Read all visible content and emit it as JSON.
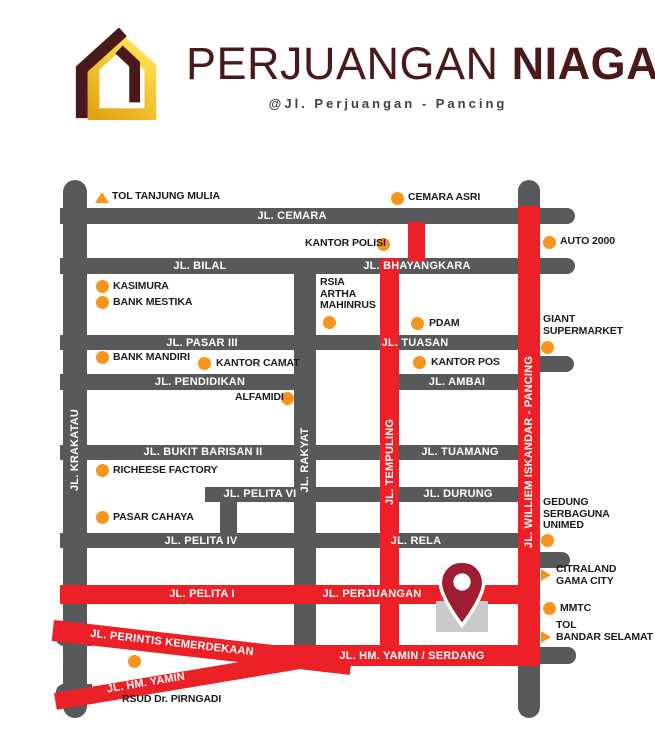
{
  "header": {
    "title_regular": "PERJUANGAN",
    "title_bold": "NIAGA",
    "subtitle": "@Jl. Perjuangan - Pancing"
  },
  "colors": {
    "road_gray": "#58595B",
    "road_red": "#EC2027",
    "poi_orange": "#F7941D",
    "brand_maroon": "#4A1A1A",
    "logo_gold_top": "#FFDE4D",
    "logo_gold_bottom": "#E2A313",
    "pin_red": "#9E1D32",
    "building_gray": "#C9CACB",
    "subtitle_gray": "#414042",
    "poi_text": "#1E1A1B"
  },
  "map": {
    "roads": [
      {
        "id": "jl-krakatau",
        "color": "gray",
        "x": 63,
        "y": 180,
        "w": 24,
        "h": 538,
        "r": "12px"
      },
      {
        "id": "pancing-north-stub",
        "color": "gray",
        "x": 518,
        "y": 180,
        "w": 22,
        "h": 42,
        "r": "11px 11px 0 0"
      },
      {
        "id": "jl-rakyat",
        "color": "gray",
        "x": 294,
        "y": 260,
        "w": 22,
        "h": 390
      },
      {
        "id": "pelita-vi-connector",
        "color": "gray",
        "x": 220,
        "y": 490,
        "w": 17,
        "h": 50
      },
      {
        "id": "jl-cemara",
        "color": "gray",
        "x": 60,
        "y": 208,
        "w": 515,
        "h": 16,
        "r": "0 8px 8px 0"
      },
      {
        "id": "jl-bilal-bhayangkara",
        "color": "gray",
        "x": 60,
        "y": 258,
        "w": 515,
        "h": 16,
        "r": "0 8px 8px 0"
      },
      {
        "id": "jl-pasar-iii-tuasan",
        "color": "gray",
        "x": 60,
        "y": 335,
        "w": 458,
        "h": 15
      },
      {
        "id": "jl-pendidikan",
        "color": "gray",
        "x": 60,
        "y": 374,
        "w": 256,
        "h": 16
      },
      {
        "id": "jl-ambai",
        "color": "gray",
        "x": 398,
        "y": 374,
        "w": 120,
        "h": 16
      },
      {
        "id": "jl-bukit-barisan-tuamang",
        "color": "gray",
        "x": 60,
        "y": 445,
        "w": 458,
        "h": 15
      },
      {
        "id": "jl-pelita-vi-durung",
        "color": "gray",
        "x": 205,
        "y": 487,
        "w": 313,
        "h": 15
      },
      {
        "id": "jl-pelita-iv-rela",
        "color": "gray",
        "x": 60,
        "y": 533,
        "w": 458,
        "h": 15
      },
      {
        "id": "east-stub-giant",
        "color": "gray",
        "x": 528,
        "y": 356,
        "w": 46,
        "h": 16,
        "r": "0 8px 8px 0"
      },
      {
        "id": "east-stub-unimed",
        "color": "gray",
        "x": 528,
        "y": 552,
        "w": 42,
        "h": 16,
        "r": "0 8px 8px 0"
      },
      {
        "id": "east-stub-serdang",
        "color": "gray",
        "x": 528,
        "y": 647,
        "w": 48,
        "h": 17,
        "r": "0 8px 8px 0"
      },
      {
        "id": "west-stub-perintis",
        "color": "gray",
        "x": 56,
        "y": 629,
        "w": 36,
        "h": 17,
        "r": "8px 0 0 8px"
      },
      {
        "id": "west-stub-yamin",
        "color": "gray",
        "x": 56,
        "y": 684,
        "w": 36,
        "h": 17,
        "r": "8px 0 0 8px"
      },
      {
        "id": "pancing-south-stub",
        "color": "gray",
        "x": 518,
        "y": 664,
        "w": 22,
        "h": 54,
        "r": "0 0 11px 11px"
      },
      {
        "id": "jl-tempuling-north",
        "color": "red",
        "x": 408,
        "y": 222,
        "w": 17,
        "h": 40
      },
      {
        "id": "jl-tempuling",
        "color": "red",
        "x": 380,
        "y": 258,
        "w": 19,
        "h": 404
      },
      {
        "id": "jl-williem-iskandar-pancing",
        "color": "red",
        "x": 518,
        "y": 206,
        "w": 22,
        "h": 460
      },
      {
        "id": "jl-pelita-i-perjuangan",
        "color": "red",
        "x": 60,
        "y": 585,
        "w": 480,
        "h": 19
      },
      {
        "id": "jl-perintis-kemerdekaan",
        "color": "red",
        "x": 54,
        "y": 620,
        "w": 300,
        "h": 21,
        "rot": 6.5
      },
      {
        "id": "jl-hm-yamin-diag",
        "color": "red",
        "x": 54,
        "y": 693,
        "w": 245,
        "h": 17,
        "rot": -9.5
      },
      {
        "id": "jl-hm-yamin-serdang",
        "color": "red",
        "x": 255,
        "y": 645,
        "w": 285,
        "h": 21
      }
    ],
    "road_labels": [
      {
        "text": "JL. CEMARA",
        "x": 292,
        "y": 216
      },
      {
        "text": "JL. BILAL",
        "x": 200,
        "y": 266
      },
      {
        "text": "JL. BHAYANGKARA",
        "x": 417,
        "y": 266
      },
      {
        "text": "JL. PASAR III",
        "x": 202,
        "y": 343
      },
      {
        "text": "JL. TUASAN",
        "x": 415,
        "y": 343
      },
      {
        "text": "JL. PENDIDIKAN",
        "x": 200,
        "y": 382
      },
      {
        "text": "JL. AMBAI",
        "x": 457,
        "y": 382
      },
      {
        "text": "JL. BUKIT BARISAN II",
        "x": 203,
        "y": 452
      },
      {
        "text": "JL. TUAMANG",
        "x": 460,
        "y": 452
      },
      {
        "text": "JL. PELITA VI",
        "x": 260,
        "y": 494
      },
      {
        "text": "JL. DURUNG",
        "x": 458,
        "y": 494
      },
      {
        "text": "JL. PELITA IV",
        "x": 201,
        "y": 541
      },
      {
        "text": "JL. RELA",
        "x": 416,
        "y": 541
      },
      {
        "text": "JL. PELITA I",
        "x": 202,
        "y": 594
      },
      {
        "text": "JL. PERJUANGAN",
        "x": 372,
        "y": 594
      },
      {
        "text": "JL. HM. YAMIN / SERDANG",
        "x": 412,
        "y": 656
      },
      {
        "text": "JL. PERINTIS KEMERDEKAAN",
        "x": 172,
        "y": 643,
        "rot": 6.5
      },
      {
        "text": "JL. HM. YAMIN",
        "x": 146,
        "y": 683,
        "rot": -9.5
      },
      {
        "text": "JL. KRAKATAU",
        "x": 75,
        "y": 450,
        "rot": -90
      },
      {
        "text": "JL. RAKYAT",
        "x": 305,
        "y": 460,
        "rot": -90
      },
      {
        "text": "JL. TEMPULING",
        "x": 390,
        "y": 462,
        "rot": -90
      },
      {
        "text": "JL. WILLIEM ISKANDAR - PANCING",
        "x": 529,
        "y": 452,
        "rot": -90
      }
    ],
    "pois": [
      {
        "text": "TOL TANJUNG MULIA",
        "icon": "tri-up",
        "ix": 95,
        "iy": 192,
        "tx": 112,
        "ty": 191
      },
      {
        "text": "CEMARA ASRI",
        "icon": "dot",
        "ix": 391,
        "iy": 192,
        "tx": 408,
        "ty": 192
      },
      {
        "text": "KANTOR POLISI",
        "icon": "dot",
        "ix": 377,
        "iy": 238,
        "tx": 305,
        "ty": 238
      },
      {
        "text": "AUTO 2000",
        "icon": "dot",
        "ix": 543,
        "iy": 236,
        "tx": 560,
        "ty": 236
      },
      {
        "text": "KASIMURA",
        "icon": "dot",
        "ix": 96,
        "iy": 280,
        "tx": 113,
        "ty": 281
      },
      {
        "text": "BANK MESTIKA",
        "icon": "dot",
        "ix": 96,
        "iy": 296,
        "tx": 113,
        "ty": 297
      },
      {
        "text": "RSIA\nARTHA\nMAHINRUS",
        "icon": "dot",
        "ix": 323,
        "iy": 316,
        "tx": 320,
        "ty": 277
      },
      {
        "text": "PDAM",
        "icon": "dot",
        "ix": 411,
        "iy": 317,
        "tx": 429,
        "ty": 318
      },
      {
        "text": "BANK MANDIRI",
        "icon": "dot",
        "ix": 96,
        "iy": 351,
        "tx": 113,
        "ty": 352
      },
      {
        "text": "KANTOR CAMAT",
        "icon": "dot",
        "ix": 198,
        "iy": 357,
        "tx": 216,
        "ty": 358
      },
      {
        "text": "KANTOR POS",
        "icon": "dot",
        "ix": 413,
        "iy": 356,
        "tx": 431,
        "ty": 357
      },
      {
        "text": "GIANT\nSUPERMARKET",
        "icon": "dot",
        "ix": 541,
        "iy": 341,
        "tx": 543,
        "ty": 314
      },
      {
        "text": "ALFAMIDI",
        "icon": "dot",
        "ix": 281,
        "iy": 392,
        "tx": 235,
        "ty": 392
      },
      {
        "text": "RICHEESE FACTORY",
        "icon": "dot",
        "ix": 96,
        "iy": 464,
        "tx": 113,
        "ty": 465
      },
      {
        "text": "PASAR CAHAYA",
        "icon": "dot",
        "ix": 96,
        "iy": 511,
        "tx": 113,
        "ty": 512
      },
      {
        "text": "GEDUNG\nSERBAGUNA\nUNIMED",
        "icon": "dot",
        "ix": 541,
        "iy": 534,
        "tx": 543,
        "ty": 497
      },
      {
        "text": "CITRALAND\nGAMA CITY",
        "icon": "tri-right",
        "ix": 541,
        "iy": 569,
        "tx": 556,
        "ty": 564
      },
      {
        "text": "MMTC",
        "icon": "dot",
        "ix": 543,
        "iy": 602,
        "tx": 560,
        "ty": 603
      },
      {
        "text": "TOL\nBANDAR SELAMAT",
        "icon": "tri-right",
        "ix": 541,
        "iy": 631,
        "tx": 556,
        "ty": 620
      },
      {
        "text": "RSUD Dr. PIRNGADI",
        "icon": "dot",
        "ix": 128,
        "iy": 655,
        "tx": 122,
        "ty": 694
      }
    ],
    "pin": {
      "x": 436,
      "y": 556,
      "w": 52,
      "h": 78
    },
    "building": {
      "x": 436,
      "y": 601,
      "w": 52,
      "h": 31
    }
  }
}
